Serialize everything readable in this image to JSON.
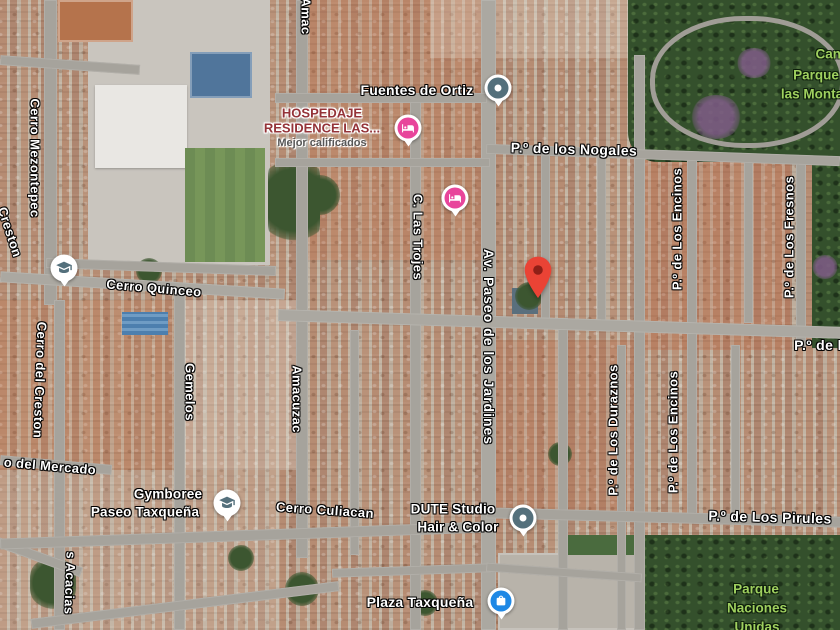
{
  "map_app": {
    "type": "google-maps-satellite-view",
    "colors": {
      "pin_red": "#EA4335",
      "pin_dot": "#8F1F17",
      "lodging_pink": "#E8459B",
      "shopping_blue": "#1E88E5",
      "generic_poi_slate": "#54707C",
      "park_label_green": "#9FD05F",
      "lodging_text_red": "#943338",
      "road_gray": "#A6A39C"
    },
    "streets": [
      {
        "text": "Amac"
      },
      {
        "text": "Cerro Mezontepec"
      },
      {
        "text": "Creston"
      },
      {
        "text": "Cerro Quinceo"
      },
      {
        "text": "Cerro del Creston"
      },
      {
        "text": "Gemelos"
      },
      {
        "text": "o del Mercado"
      },
      {
        "text": "s Acacias"
      },
      {
        "text": "Amacuzac"
      },
      {
        "text": "C. Las Trojes"
      },
      {
        "text": "Av. Paseo de los Jardines"
      },
      {
        "text": "P.º de los Nogales"
      },
      {
        "text": "P.º de Los Encinos"
      },
      {
        "text": "P.º de Los Fresnos"
      },
      {
        "text": "P.º de l"
      },
      {
        "text": "P.º de Los Duraznos"
      },
      {
        "text": "P.º de Los Encinos"
      },
      {
        "text": "Cerro Culiacan"
      },
      {
        "text": "P.º de Los Pirules"
      }
    ],
    "pois": [
      {
        "label": "Fuentes de Ortiz",
        "icon": "generic-place"
      },
      {
        "line1": "HOSPEDAJE",
        "line2": "RESIDENCE LAS...",
        "sublabel": "Mejor calificados",
        "icon": "lodging"
      },
      {
        "label": "",
        "icon": "lodging"
      },
      {
        "label": "",
        "icon": "education"
      },
      {
        "line1": "Gymboree",
        "line2": "Paseo Taxqueña",
        "icon": "education"
      },
      {
        "line1": "DUTE Studio",
        "line2": "Hair & Color",
        "icon": "generic-place"
      },
      {
        "label": "Plaza Taxqueña",
        "icon": "shopping"
      },
      {
        "label": "",
        "icon": "destination-pin"
      }
    ],
    "parks": [
      {
        "line1": "Canc",
        "line2": "Parque",
        "line3": "las Monta"
      },
      {
        "line1": "Parque",
        "line2": "Naciones",
        "line3": "Unidas"
      }
    ]
  }
}
